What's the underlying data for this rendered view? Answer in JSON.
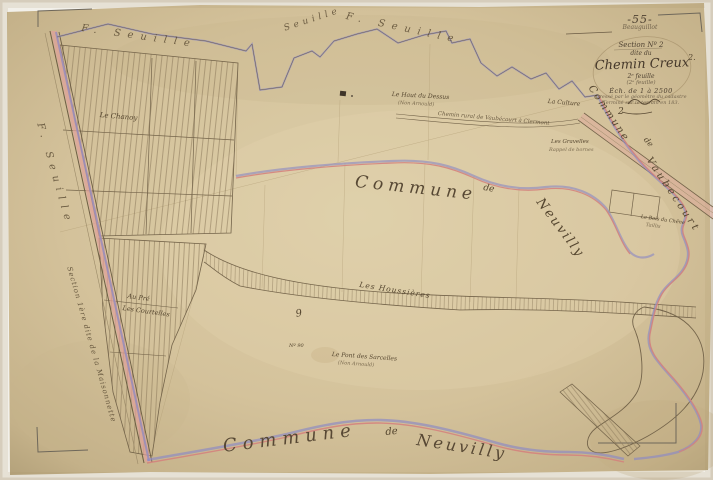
{
  "cartouche": {
    "dept_number": "-55-",
    "stamp_line": "Beauguillot",
    "section_line": "Section Nº 2",
    "dite_line": "dite du",
    "title": "Chemin Creux",
    "sub1": "2ᵉ feuille",
    "sub2": "(2ᵉ feuille)",
    "scale_line": "Éch. de 1 à 2500",
    "note1": "Dressé par le géomètre du cadastre",
    "note2": "Terminé sur le terrain en 183."
  },
  "neighbors": {
    "top_left": "F. Seuille",
    "top_mid": "Seuille",
    "top_right": "F. Seuille",
    "left_edge": "F. Seuille",
    "center_commune": "Commune",
    "center_de": "de",
    "center_name": "Neuvilly",
    "bottom_commune": "Commune",
    "bottom_de": "de",
    "bottom_name": "Neuvilly",
    "right_commune": "Commune",
    "right_de": "de",
    "right_name": "Vaubecourt"
  },
  "roads": {
    "section_label": "Section 1ère dite de la Maisonnette",
    "chemin_label": "Chemin rural de Vaubécourt à Clermont"
  },
  "places": {
    "chanoy": "Le Chanoy",
    "au_pre_1": "Au Pré",
    "au_pre_2": "Les Courtelles",
    "haut_dessus_1": "Le Haut du Dessus",
    "haut_dessus_2": "(Non Arnould)",
    "culture": "La Culture",
    "gravelles_1": "Les Gravelles",
    "gravelles_2": "Rappel de bornes",
    "houssieres": "Les Houssières",
    "no90": "Nº 90",
    "pont_1": "Le Pont des Sarcelles",
    "pont_2": "(Non Arnould)",
    "bois_1": "Le Bois du Chêne",
    "bois_2": "Taillis"
  },
  "numbers": {
    "two_a": "2",
    "two_b": "2.",
    "nine": "9"
  },
  "colors": {
    "paper": "#d6c5a0",
    "boundary_pink": "#d4837d",
    "boundary_blue": "#8f8cc2",
    "ink": "#6d5d44"
  }
}
